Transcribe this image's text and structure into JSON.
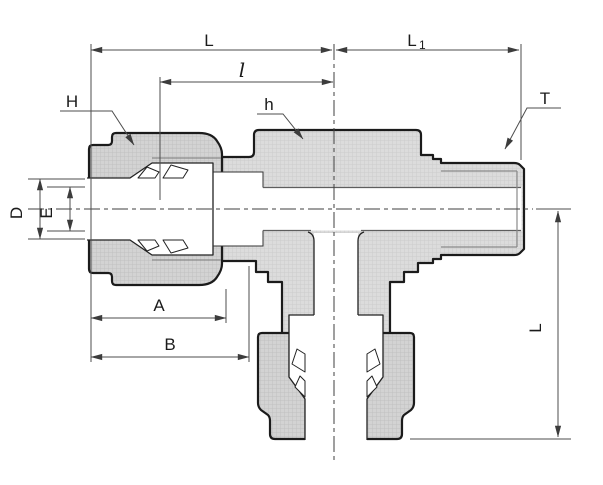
{
  "diagram": {
    "description": "Cross-section engineering drawing of a compression tube tee fitting: tube nut on left run, male threaded right run, tube nut on bottom branch, with dimension callouts",
    "dimensions": {
      "L_top": "L",
      "L1_main": "L",
      "L1_sub": "1",
      "l_center": "l",
      "H_nut_hex": "H",
      "h_body_hex": "h",
      "T_thread": "T",
      "D_tube_hole": "D",
      "E_orifice": "E",
      "A_nut_length": "A",
      "B_to_body": "B",
      "L_vertical": "L"
    },
    "colors": {
      "background": "#ffffff",
      "outline": "#1b1b1b",
      "metal_fill": "#dcdcdc",
      "nut_fill": "#d2d2d2",
      "hatch_line": "#c8c8c8",
      "dimension_line": "#4d4d4d",
      "label_text": "#1b1b1b"
    }
  }
}
